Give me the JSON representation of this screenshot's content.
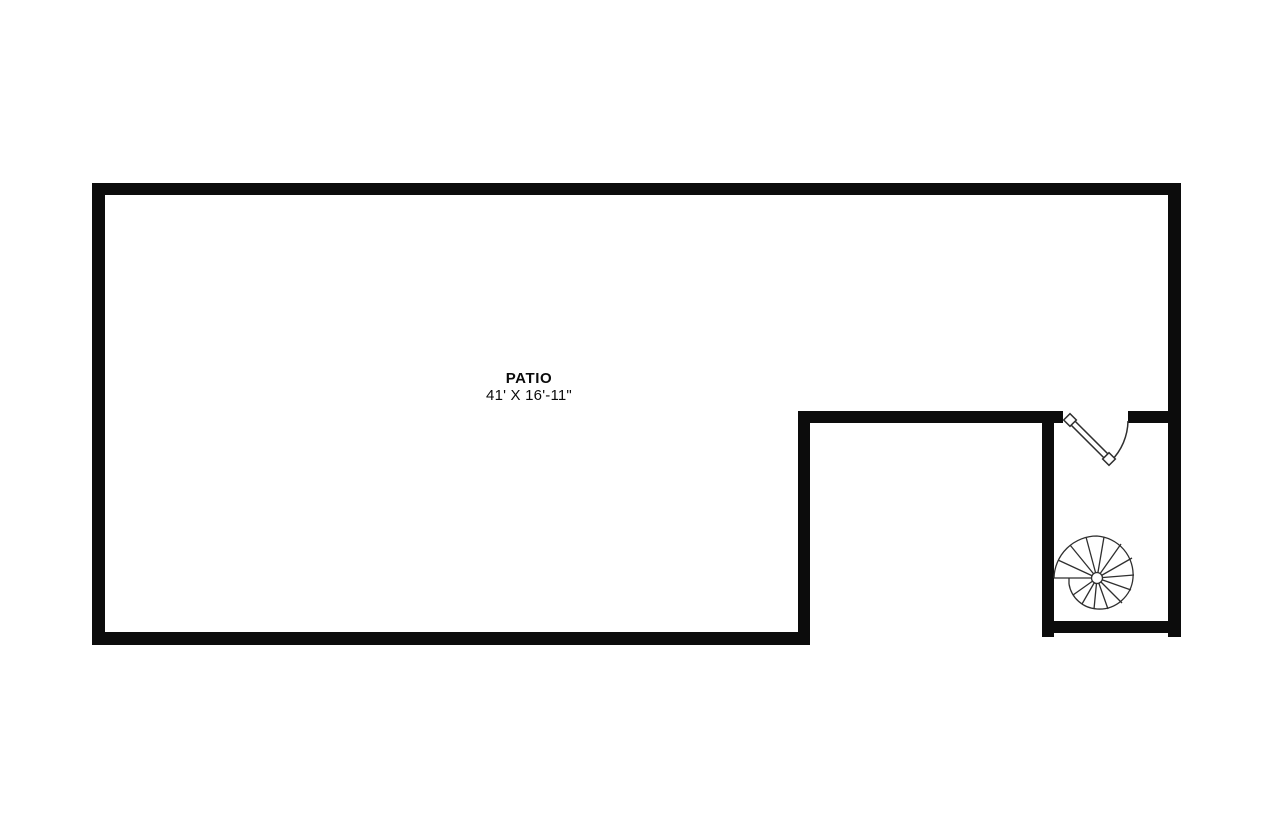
{
  "page": {
    "background_color": "#ffffff"
  },
  "floorplan": {
    "room_label": "PATIO",
    "room_dimensions": "41' X 16'-11\"",
    "wall_color": "#0c0c0c",
    "symbol_line_color": "#2f2f2f",
    "fixtures": [
      {
        "name": "door-swing",
        "type": "door"
      },
      {
        "name": "spiral-staircase",
        "type": "stairs"
      }
    ]
  }
}
